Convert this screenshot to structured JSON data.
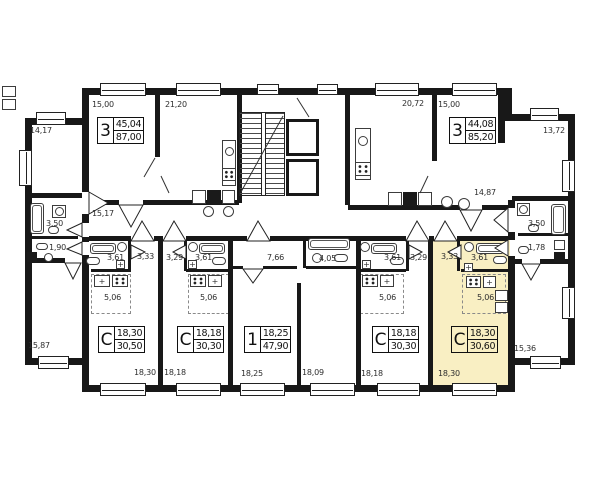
{
  "colors": {
    "highlight_unit": "#F9EFC3",
    "wall": "#181818"
  },
  "apartments": [
    {
      "id": "apt-3-left",
      "type": "3",
      "living_area": "45,04",
      "total_area": "87,00"
    },
    {
      "id": "apt-3-right",
      "type": "3",
      "living_area": "44,08",
      "total_area": "85,20"
    },
    {
      "id": "studio-1",
      "type": "С",
      "living_area": "18,30",
      "total_area": "30,50"
    },
    {
      "id": "studio-2",
      "type": "С",
      "living_area": "18,18",
      "total_area": "30,30"
    },
    {
      "id": "apt-1",
      "type": "1",
      "living_area": "18,25",
      "total_area": "47,90"
    },
    {
      "id": "studio-3",
      "type": "С",
      "living_area": "18,18",
      "total_area": "30,30"
    },
    {
      "id": "studio-4",
      "type": "С",
      "living_area": "18,30",
      "total_area": "30,60",
      "highlighted": true
    }
  ],
  "room_dims": {
    "top_room_1": "15,00",
    "top_room_2": "21,20",
    "top_room_3": "20,72",
    "top_room_4": "15,00",
    "left_room": "14,17",
    "right_room": "13,72",
    "hall_left": "15,17",
    "hall_right": "14,87",
    "bath_left": "3,50",
    "wc_left": "1,90",
    "bath_right": "3,50",
    "wc_right": "1,78",
    "bottom_left_room": "15,87",
    "bottom_right_room": "15,36",
    "u1_bath": "3,61",
    "u1_hall": "3,33",
    "u2_hall": "3,29",
    "u2_bath": "3,61",
    "a1_hall": "7,66",
    "a1_bath": "4,05",
    "u3_bath": "3,61",
    "u3_hall": "3,29",
    "u4_hall": "3,33",
    "u4_bath": "3,61",
    "u1_kitchen": "5,06",
    "u2_kitchen": "5,06",
    "u3_kitchen": "5,06",
    "u4_kitchen": "5,06",
    "room_1": "18,30",
    "room_2": "18,18",
    "room_3": "18,25",
    "room_4": "18,09",
    "room_5": "18,18",
    "room_6": "18,30"
  }
}
